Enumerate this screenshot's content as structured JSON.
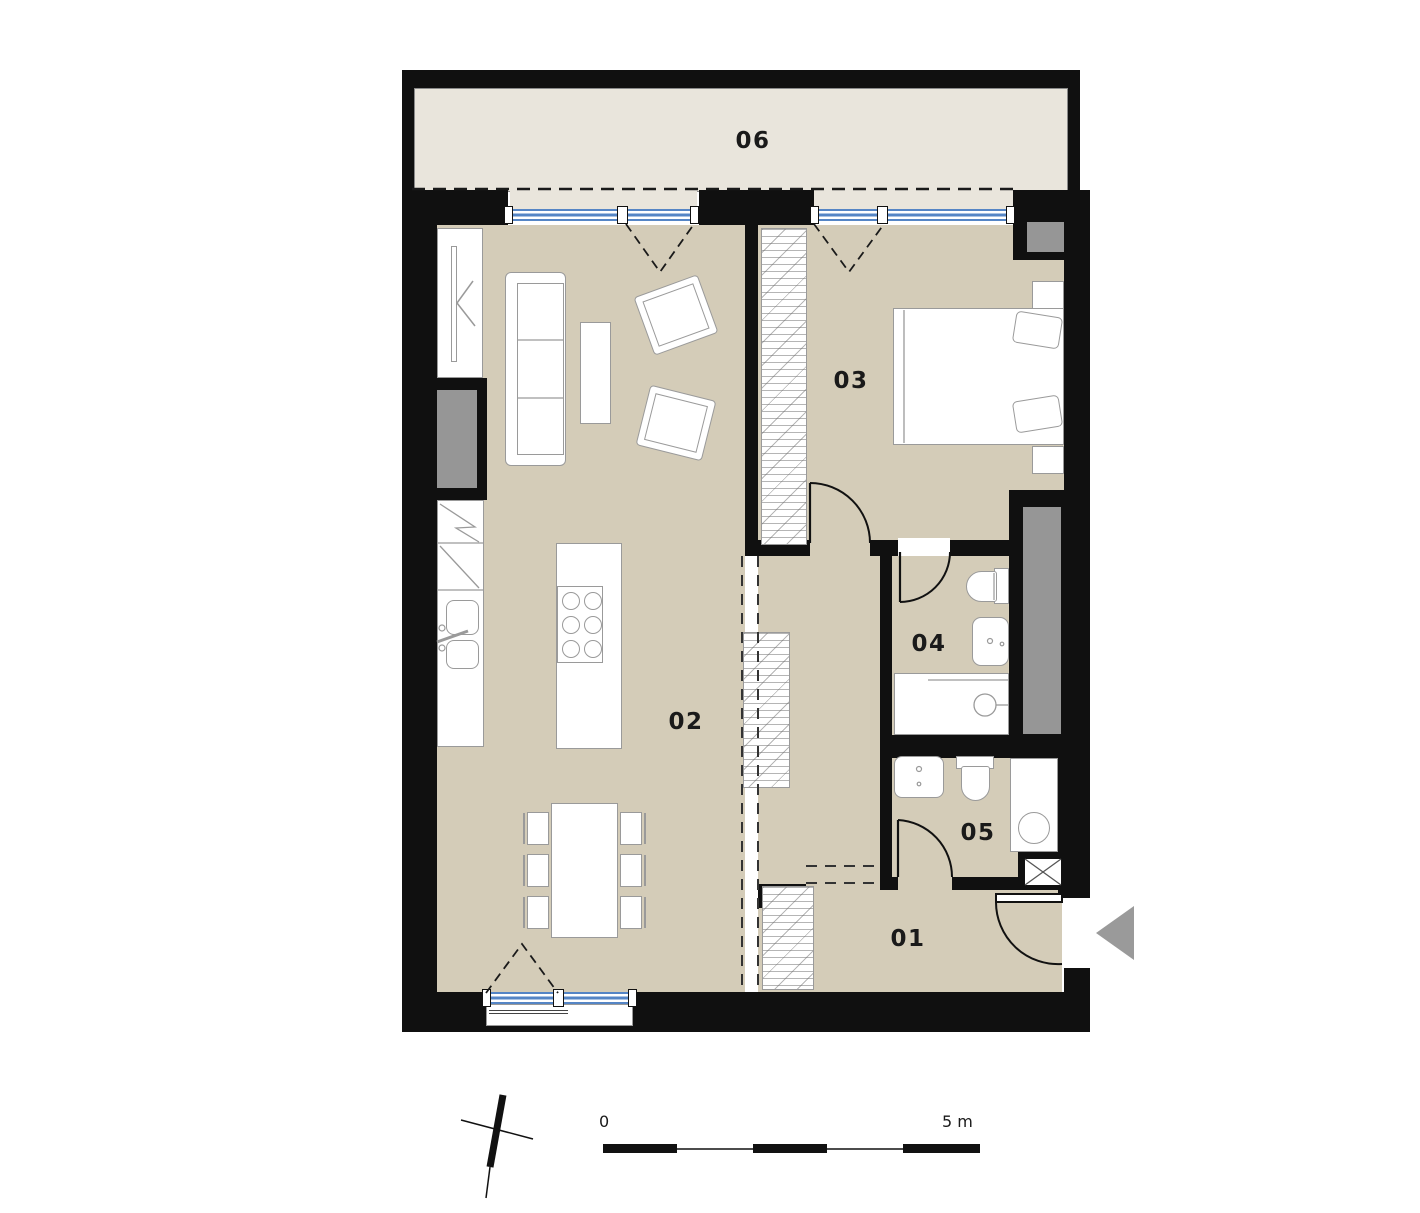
{
  "title": "Apartment floor plan",
  "rooms": {
    "r01": "01",
    "r02": "02",
    "r03": "03",
    "r04": "04",
    "r05": "05",
    "r06": "06"
  },
  "scale_bar": {
    "start": "0",
    "end": "5 m"
  },
  "colors": {
    "wall": "#101010",
    "floor": "#d4ccb8",
    "balcony": "#e9e5dc",
    "shaft": "#969696",
    "glazing": "#5585c5",
    "stroke": "#9a9a9a",
    "arrow": "#9a9a9a",
    "ink": "#1a1a1a"
  }
}
